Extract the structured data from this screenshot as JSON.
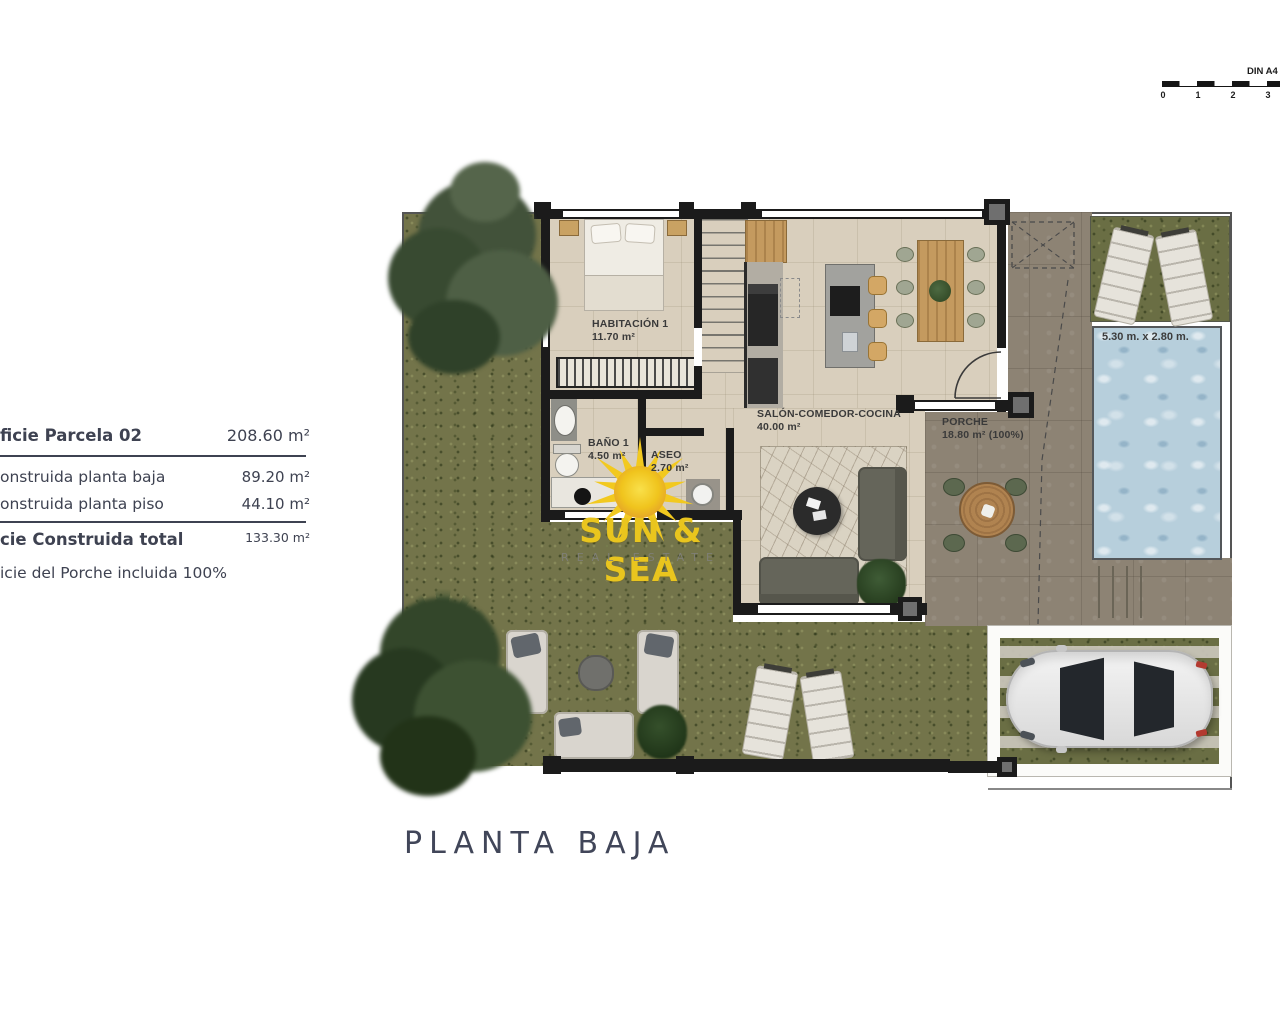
{
  "scale_bar": {
    "sheet_label": "DIN A4",
    "ticks": [
      "0",
      "1",
      "2",
      "3"
    ]
  },
  "info_panel": {
    "rows": [
      {
        "label": "ficie Parcela 02",
        "value": "208.60 m²"
      },
      {
        "label": "onstruida planta baja",
        "value": "89.20 m²"
      },
      {
        "label": "onstruida planta piso",
        "value": "44.10 m²"
      },
      {
        "label": "cie Construida total",
        "value": "133.30 m²"
      },
      {
        "label": "icie del Porche incluida 100%",
        "value": ""
      }
    ]
  },
  "plan": {
    "title": "PLANTA BAJA",
    "rooms": [
      {
        "name": "HABITACIÓN 1",
        "area": "11.70 m²"
      },
      {
        "name": "BAÑO 1",
        "area": "4.50 m²"
      },
      {
        "name": "ASEO",
        "area": "2.70 m²"
      },
      {
        "name": "SALÓN-COMEDOR-COCINA",
        "area": "40.00 m²"
      },
      {
        "name": "PORCHE",
        "area": "18.80 m² (100%)"
      }
    ],
    "pool": {
      "label": "5.30 m. x 2.80 m."
    }
  },
  "watermark": {
    "brand": "SUN & SEA",
    "tagline": "REAL ESTATE"
  },
  "colors": {
    "brand_yellow": "#e9c51e",
    "pool_blue": "#b7cfdc",
    "grass_green": "#73744a",
    "terrace_taupe": "#8d8374",
    "floor_beige": "#d9cfbd",
    "wall_black": "#1b1b1b",
    "title_slate": "#414659"
  }
}
